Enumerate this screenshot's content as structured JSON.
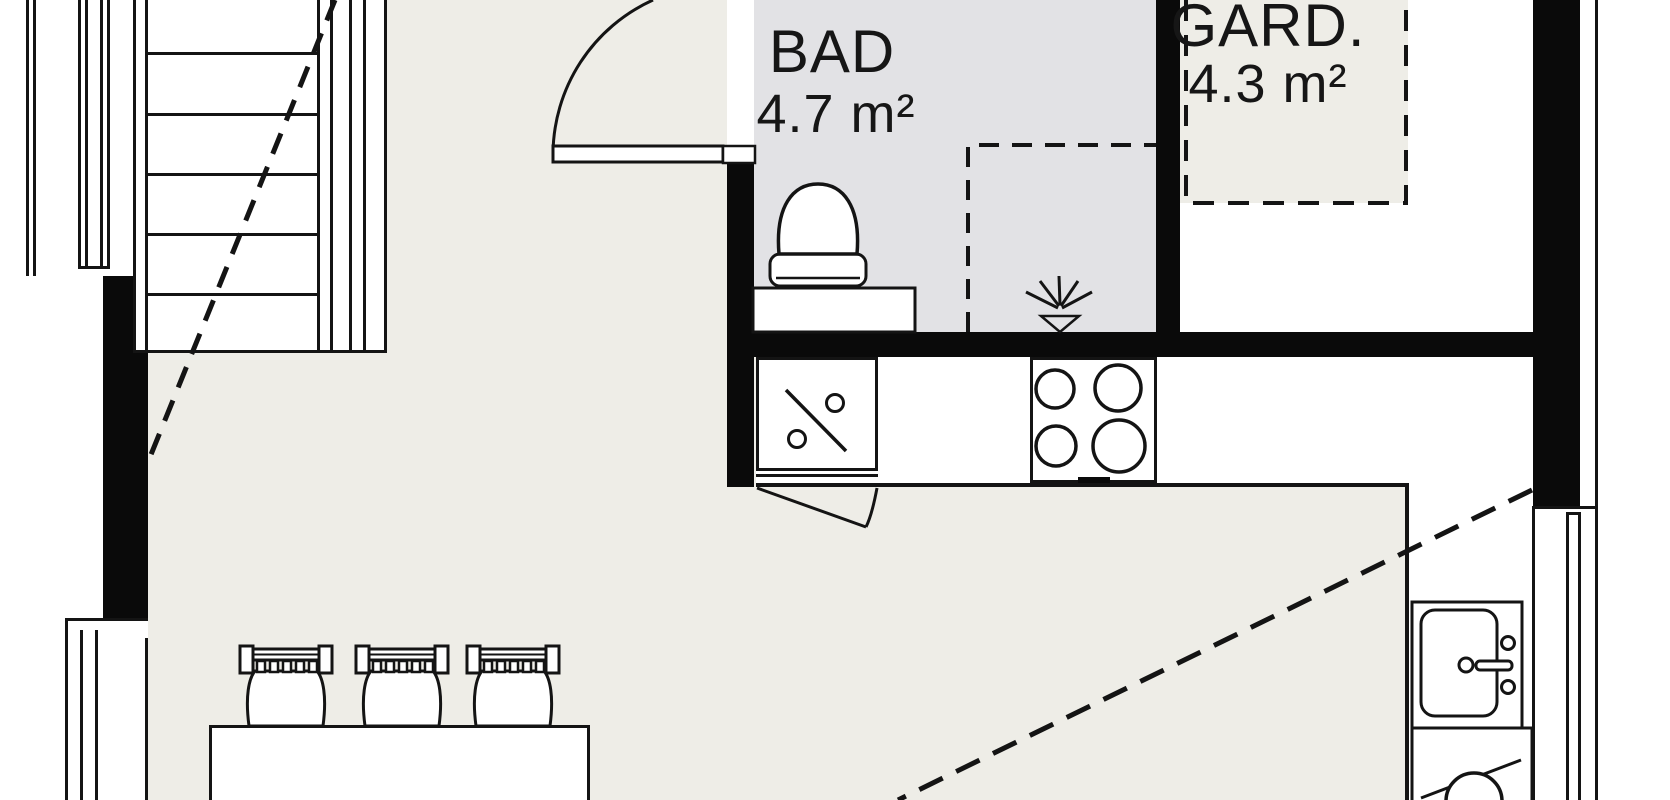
{
  "plan_title": "apartment-floor-plan",
  "rooms": {
    "bad": {
      "label": "BAD",
      "area": "4.7 m²"
    },
    "gard": {
      "label": "GARD.",
      "area": "4.3 m²"
    }
  },
  "colors": {
    "floor": "#eeede7",
    "bath_floor": "#e2e2e5",
    "wall": "#0a0a0a",
    "line": "#141414",
    "white": "#ffffff",
    "text": "#161616"
  },
  "staircase": {
    "tread_lines_y": [
      52,
      113,
      173,
      233,
      293
    ],
    "rail_lines_x": [
      317,
      330,
      349,
      363,
      384
    ]
  },
  "dining": {
    "chair_centers_x": [
      286,
      402,
      513
    ]
  },
  "kitchen": {
    "cooktop_burners": [
      {
        "cx": 1055,
        "cy": 389,
        "r": 19
      },
      {
        "cx": 1118,
        "cy": 388,
        "r": 23
      },
      {
        "cx": 1056,
        "cy": 446,
        "r": 20
      },
      {
        "cx": 1119,
        "cy": 446,
        "r": 26
      }
    ]
  },
  "icons": [
    "staircase",
    "entry-door",
    "toilet-icon",
    "shower-head-icon",
    "vanity-counter",
    "dishwasher-icon",
    "cooktop-icon",
    "cabinet-door-swing",
    "kitchen-sink-icon",
    "washing-machine-icon",
    "dining-table",
    "chair-icon",
    "window-left-upper",
    "window-left-lower",
    "window-right",
    "ceiling-height-line-left",
    "ceiling-height-line-right",
    "wardrobe-zone"
  ]
}
